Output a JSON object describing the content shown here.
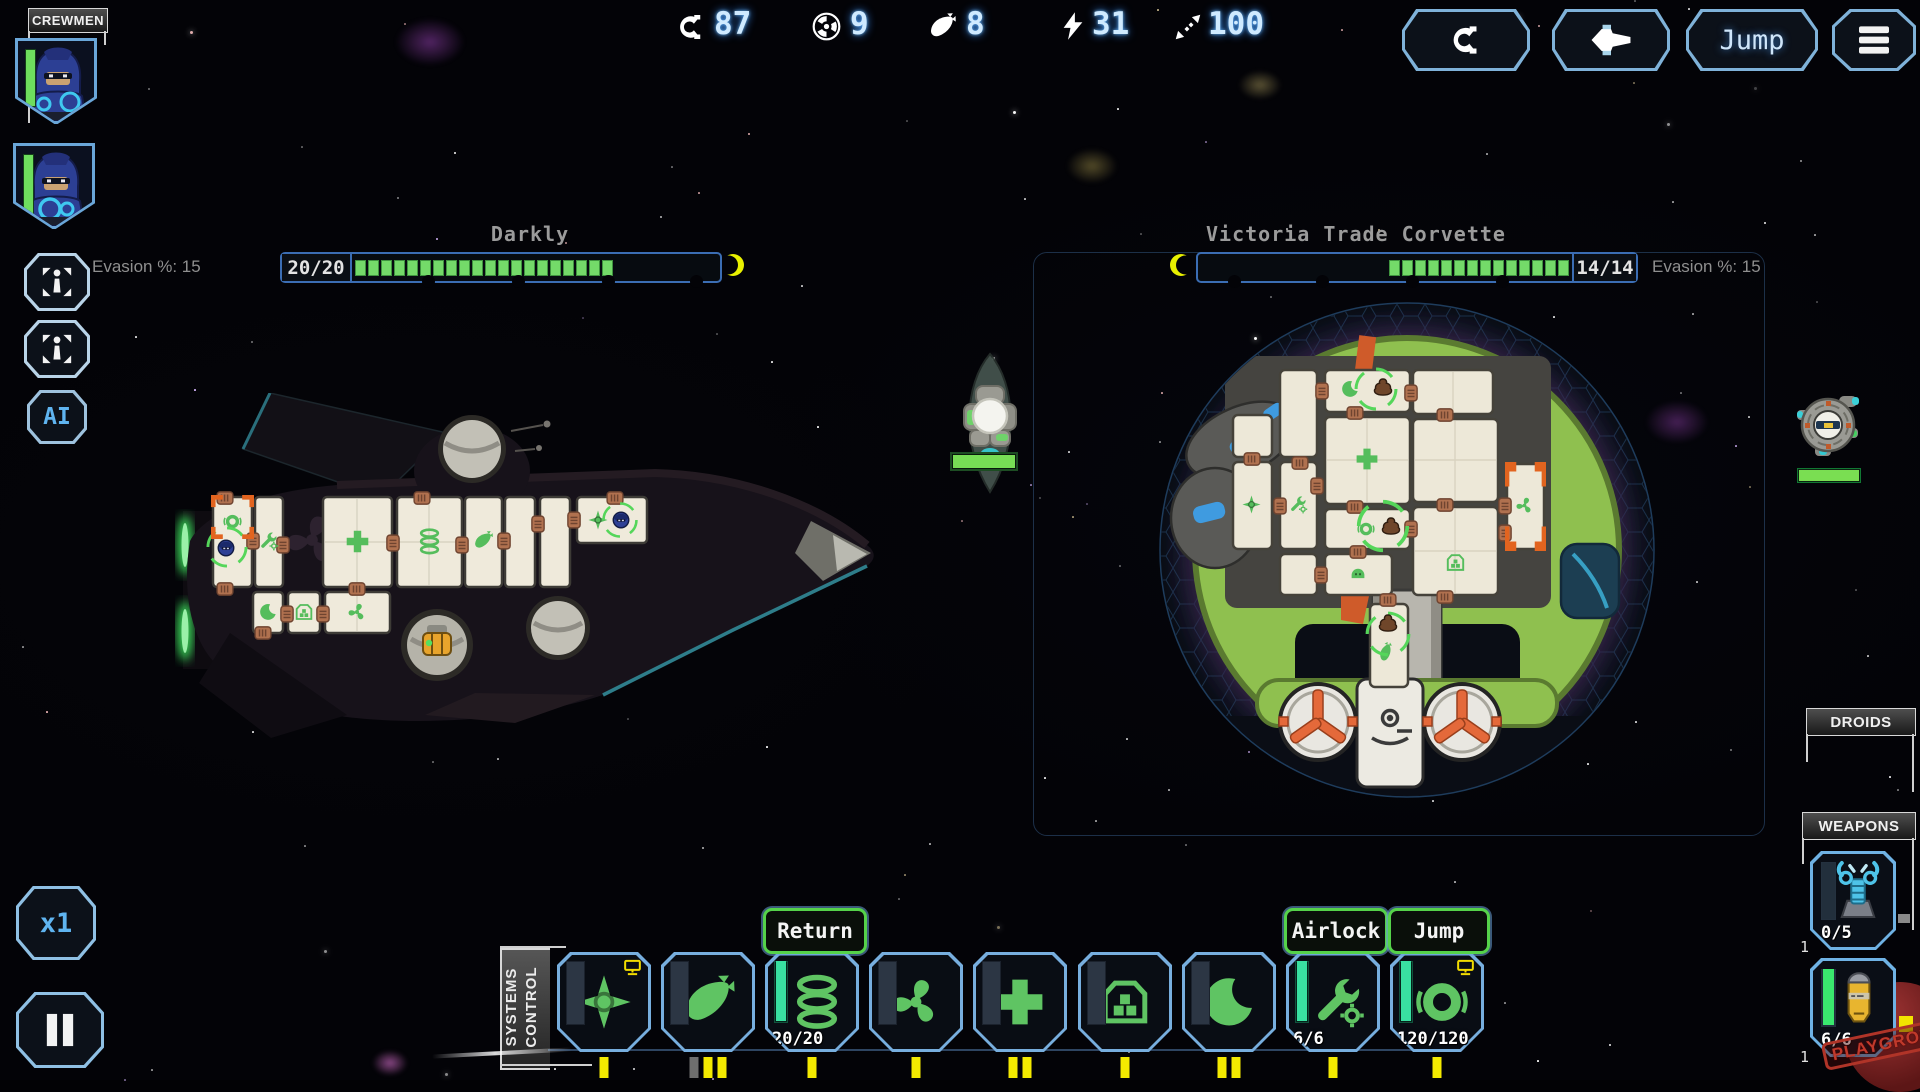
{
  "topbar": {
    "resources": [
      {
        "name": "credits",
        "value": "87"
      },
      {
        "name": "nuclear-fuel",
        "value": "9"
      },
      {
        "name": "missiles",
        "value": "8"
      },
      {
        "name": "energy",
        "value": "31"
      },
      {
        "name": "jump-range",
        "value": "100"
      }
    ],
    "jump_label": "Jump"
  },
  "crew_panel": {
    "title": "CREWMEN"
  },
  "left_controls": {
    "ai_label": "AI",
    "speed_label": "x1"
  },
  "player_ship": {
    "name": "Darkly",
    "hull": "20/20",
    "hull_current": 20,
    "hull_max": 20,
    "evasion_label": "Evasion %: 15"
  },
  "enemy_ship": {
    "name": "Victoria Trade Corvette",
    "hull": "14/14",
    "hull_current": 14,
    "hull_max": 14,
    "evasion_label": "Evasion %: 15"
  },
  "systems_control": {
    "title_line1": "SYSTEMS",
    "title_line2": "CONTROL",
    "return_label": "Return",
    "airlock_label": "Airlock",
    "jump_label": "Jump",
    "engine_gauge": "20/20",
    "airlock_gauge": "6/6",
    "jump_gauge": "120/120",
    "systems": [
      {
        "id": "shields",
        "pips": [
          "yellow"
        ],
        "manned": true
      },
      {
        "id": "missiles",
        "pips": [
          "gray",
          "yellow",
          "yellow"
        ],
        "manned": false
      },
      {
        "id": "engines",
        "pips": [
          "yellow"
        ],
        "manned": false
      },
      {
        "id": "vents",
        "pips": [
          "yellow"
        ],
        "manned": false
      },
      {
        "id": "medbay",
        "pips": [
          "yellow",
          "yellow"
        ],
        "manned": false
      },
      {
        "id": "storage",
        "pips": [
          "yellow"
        ],
        "manned": false
      },
      {
        "id": "quarters",
        "pips": [
          "yellow",
          "yellow"
        ],
        "manned": false
      },
      {
        "id": "airlock",
        "pips": [
          "yellow"
        ],
        "manned": false
      },
      {
        "id": "jump-drive",
        "pips": [
          "yellow"
        ],
        "manned": true
      }
    ]
  },
  "side_panels": {
    "droids_title": "DROIDS",
    "weapons_title": "WEAPONS",
    "weapons": [
      {
        "type": "laser-turret",
        "ammo": "0/5",
        "count": "1"
      },
      {
        "type": "missile-launcher",
        "ammo": "6/6",
        "count": "1"
      }
    ]
  },
  "watermark": "PLAYGROUND"
}
